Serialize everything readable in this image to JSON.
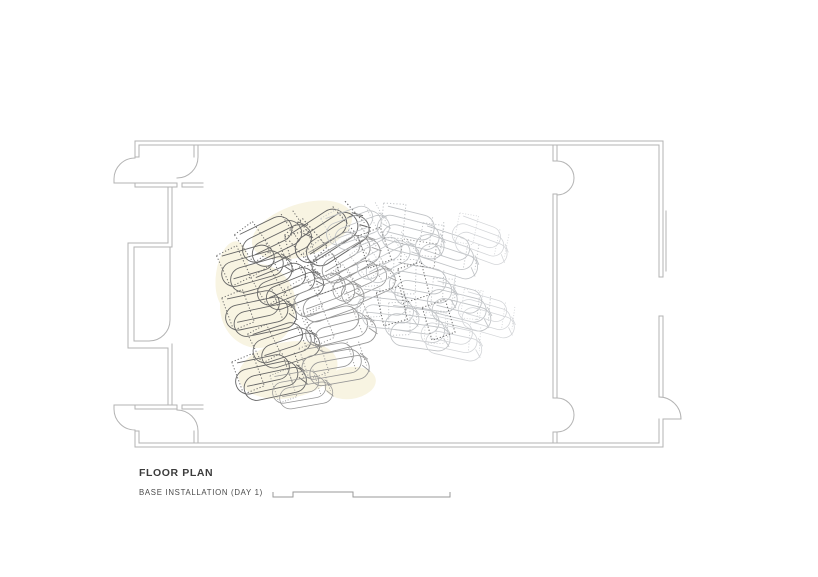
{
  "titleblock": {
    "title": "FLOOR PLAN",
    "subtitle": "BASE INSTALLATION (DAY 1)"
  },
  "palette": {
    "wall": "#b3b3b3",
    "text": "#3c3c3c",
    "scalebar": "#9a9a9a",
    "highlight": "#f8f4e2",
    "tones": {
      "dark": "#666666",
      "mid": "#979797",
      "light": "#c0c3c6",
      "xlight": "#d3d5d8"
    }
  },
  "installation": {
    "blobs": [
      {
        "cx": 302,
        "cy": 230,
        "rx": 52,
        "ry": 26,
        "rot": -18
      },
      {
        "cx": 258,
        "cy": 306,
        "rx": 38,
        "ry": 42,
        "rot": 0
      },
      {
        "cx": 288,
        "cy": 370,
        "rx": 50,
        "ry": 28,
        "rot": -10
      },
      {
        "cx": 232,
        "cy": 275,
        "rx": 16,
        "ry": 34,
        "rot": 8
      },
      {
        "cx": 350,
        "cy": 383,
        "rx": 26,
        "ry": 16,
        "rot": -8
      }
    ],
    "chairs": [
      {
        "x": 288,
        "y": 242,
        "r": -26,
        "s": 1.0,
        "tone": "dark"
      },
      {
        "x": 268,
        "y": 272,
        "r": -16,
        "s": 1.0,
        "tone": "dark"
      },
      {
        "x": 301,
        "y": 288,
        "r": -22,
        "s": 0.95,
        "tone": "dark"
      },
      {
        "x": 272,
        "y": 318,
        "r": -12,
        "s": 1.0,
        "tone": "dark"
      },
      {
        "x": 297,
        "y": 348,
        "r": -18,
        "s": 0.95,
        "tone": "dark"
      },
      {
        "x": 282,
        "y": 382,
        "r": -12,
        "s": 1.0,
        "tone": "dark"
      },
      {
        "x": 312,
        "y": 394,
        "r": -10,
        "s": 0.85,
        "tone": "mid"
      },
      {
        "x": 344,
        "y": 236,
        "r": -33,
        "s": 1.1,
        "tone": "dark"
      },
      {
        "x": 357,
        "y": 257,
        "r": -30,
        "s": 1.0,
        "tone": "mid"
      },
      {
        "x": 340,
        "y": 300,
        "r": -20,
        "s": 1.0,
        "tone": "mid"
      },
      {
        "x": 352,
        "y": 333,
        "r": -14,
        "s": 1.0,
        "tone": "mid"
      },
      {
        "x": 346,
        "y": 369,
        "r": -10,
        "s": 0.95,
        "tone": "mid"
      },
      {
        "x": 374,
        "y": 284,
        "r": -24,
        "s": 0.9,
        "tone": "mid"
      },
      {
        "x": 368,
        "y": 230,
        "r": -20,
        "s": 0.9,
        "tone": "light"
      },
      {
        "x": 420,
        "y": 243,
        "r": 14,
        "s": 1.0,
        "tone": "light"
      },
      {
        "x": 455,
        "y": 263,
        "r": 18,
        "s": 0.95,
        "tone": "light"
      },
      {
        "x": 487,
        "y": 250,
        "r": 20,
        "s": 0.85,
        "tone": "xlight"
      },
      {
        "x": 433,
        "y": 297,
        "r": 10,
        "s": 1.0,
        "tone": "light"
      },
      {
        "x": 468,
        "y": 316,
        "r": 14,
        "s": 0.95,
        "tone": "light"
      },
      {
        "x": 427,
        "y": 337,
        "r": 8,
        "s": 0.95,
        "tone": "light"
      },
      {
        "x": 460,
        "y": 347,
        "r": 12,
        "s": 0.9,
        "tone": "xlight"
      },
      {
        "x": 494,
        "y": 324,
        "r": 16,
        "s": 0.85,
        "tone": "xlight"
      },
      {
        "x": 398,
        "y": 260,
        "r": -28,
        "s": 0.9,
        "tone": "light"
      },
      {
        "x": 397,
        "y": 318,
        "r": 6,
        "s": 0.9,
        "tone": "light"
      }
    ],
    "boxes": [
      {
        "x": 374,
        "y": 250,
        "r": -12,
        "tone": "dark"
      },
      {
        "x": 413,
        "y": 284,
        "r": -8,
        "tone": "dark"
      },
      {
        "x": 391,
        "y": 308,
        "r": -6,
        "tone": "dark"
      },
      {
        "x": 438,
        "y": 322,
        "r": -10,
        "tone": "dark"
      },
      {
        "x": 300,
        "y": 252,
        "r": -8,
        "tone": "dark"
      },
      {
        "x": 326,
        "y": 276,
        "r": -10,
        "tone": "dark"
      },
      {
        "x": 420,
        "y": 255,
        "r": -75,
        "tone": "mid"
      }
    ]
  }
}
